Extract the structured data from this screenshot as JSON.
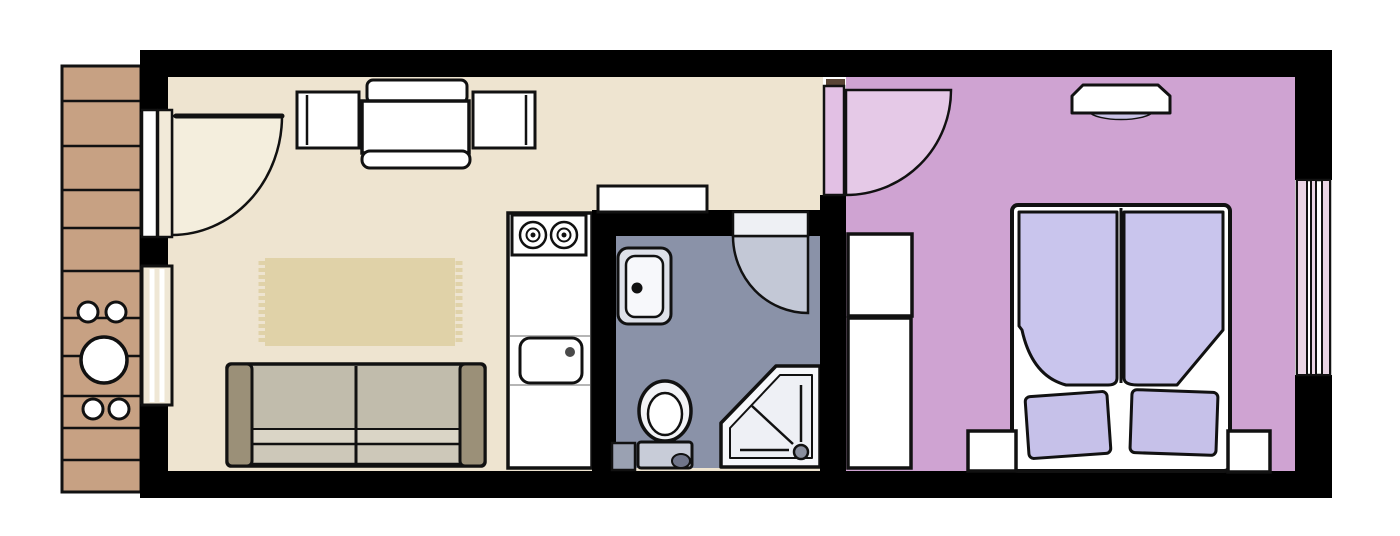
{
  "meta": {
    "title": "apartment-floor-plan",
    "canvas": {
      "width": 1400,
      "height": 536,
      "background": "#ffffff"
    }
  },
  "rooms": [
    {
      "id": "balcony",
      "label": "balcony",
      "floor_color": "#c7a183"
    },
    {
      "id": "living-room",
      "label": "living-room-kitchen",
      "floor_color": "#eee4d0"
    },
    {
      "id": "bathroom",
      "label": "bathroom",
      "floor_color": "#8a92a8"
    },
    {
      "id": "bedroom",
      "label": "bedroom",
      "floor_color": "#cfa3d2"
    }
  ],
  "palette": {
    "wall": "#000000",
    "outline": "#111111",
    "living_floor": "#eee4d0",
    "bedroom_floor": "#cfa3d2",
    "bathroom_floor": "#8a92a8",
    "balcony_deck": "#c7a183",
    "rug": "#e0d2a8",
    "sofa_body": "#c1bcac",
    "sofa_armrest": "#9b9078",
    "duvet": "#c9c5ed",
    "pillow": "#c6c1e9",
    "door_swing_cream": "#f4eedd",
    "door_swing_gray": "#c3c8d6",
    "door_swing_pink": "#e5c9e7"
  },
  "shapes": [
    {
      "n": "balcony-deck",
      "t": "rect",
      "x": 62,
      "y": 66,
      "w": 79,
      "h": 426,
      "fill": "#c7a183",
      "stroke": "#111111",
      "sw": 3
    },
    {
      "n": "balcony-plank-line",
      "t": "line",
      "x1": 63,
      "y1": 101,
      "x2": 140,
      "y2": 101,
      "stroke": "#111111",
      "sw": 2.5
    },
    {
      "n": "balcony-plank-line",
      "t": "line",
      "x1": 63,
      "y1": 146,
      "x2": 140,
      "y2": 146,
      "stroke": "#111111",
      "sw": 2.5
    },
    {
      "n": "balcony-plank-line",
      "t": "line",
      "x1": 63,
      "y1": 190,
      "x2": 140,
      "y2": 190,
      "stroke": "#111111",
      "sw": 2.5
    },
    {
      "n": "balcony-plank-line",
      "t": "line",
      "x1": 63,
      "y1": 228,
      "x2": 140,
      "y2": 228,
      "stroke": "#111111",
      "sw": 2.5
    },
    {
      "n": "balcony-plank-line",
      "t": "line",
      "x1": 63,
      "y1": 271,
      "x2": 140,
      "y2": 271,
      "stroke": "#111111",
      "sw": 2.5
    },
    {
      "n": "balcony-plank-line",
      "t": "line",
      "x1": 63,
      "y1": 318,
      "x2": 140,
      "y2": 318,
      "stroke": "#111111",
      "sw": 2.5
    },
    {
      "n": "balcony-plank-line",
      "t": "line",
      "x1": 63,
      "y1": 356,
      "x2": 140,
      "y2": 356,
      "stroke": "#111111",
      "sw": 2.5
    },
    {
      "n": "balcony-plank-line",
      "t": "line",
      "x1": 63,
      "y1": 396,
      "x2": 140,
      "y2": 396,
      "stroke": "#111111",
      "sw": 2.5
    },
    {
      "n": "balcony-plank-line",
      "t": "line",
      "x1": 63,
      "y1": 428,
      "x2": 140,
      "y2": 428,
      "stroke": "#111111",
      "sw": 2.5
    },
    {
      "n": "balcony-plank-line",
      "t": "line",
      "x1": 63,
      "y1": 460,
      "x2": 140,
      "y2": 460,
      "stroke": "#111111",
      "sw": 2.5
    },
    {
      "n": "balcony-stool",
      "t": "circle",
      "cx": 88,
      "cy": 312,
      "r": 10,
      "fill": "#ffffff",
      "stroke": "#111111",
      "sw": 3
    },
    {
      "n": "balcony-stool",
      "t": "circle",
      "cx": 116,
      "cy": 312,
      "r": 10,
      "fill": "#ffffff",
      "stroke": "#111111",
      "sw": 3
    },
    {
      "n": "balcony-stool",
      "t": "circle",
      "cx": 93,
      "cy": 409,
      "r": 10,
      "fill": "#ffffff",
      "stroke": "#111111",
      "sw": 3
    },
    {
      "n": "balcony-stool",
      "t": "circle",
      "cx": 119,
      "cy": 409,
      "r": 10,
      "fill": "#ffffff",
      "stroke": "#111111",
      "sw": 3
    },
    {
      "n": "balcony-table",
      "t": "circle",
      "cx": 104,
      "cy": 360,
      "r": 23,
      "fill": "#ffffff",
      "stroke": "#111111",
      "sw": 3.5
    },
    {
      "n": "wall-top",
      "t": "rect",
      "x": 140,
      "y": 50,
      "w": 1192,
      "h": 27,
      "fill": "#000000"
    },
    {
      "n": "wall-bottom",
      "t": "rect",
      "x": 140,
      "y": 471,
      "w": 1192,
      "h": 27,
      "fill": "#000000"
    },
    {
      "n": "wall-left-upper",
      "t": "rect",
      "x": 140,
      "y": 50,
      "w": 28,
      "h": 62,
      "fill": "#000000"
    },
    {
      "n": "wall-left-mid",
      "t": "rect",
      "x": 140,
      "y": 235,
      "w": 38,
      "h": 31,
      "fill": "#000000"
    },
    {
      "n": "wall-left-lower",
      "t": "rect",
      "x": 140,
      "y": 404,
      "w": 29,
      "h": 70,
      "fill": "#000000"
    },
    {
      "n": "wall-right-upper",
      "t": "rect",
      "x": 1295,
      "y": 50,
      "w": 37,
      "h": 130,
      "fill": "#000000"
    },
    {
      "n": "wall-right-lower",
      "t": "rect",
      "x": 1295,
      "y": 375,
      "w": 37,
      "h": 123,
      "fill": "#000000"
    },
    {
      "n": "living-room-floor",
      "t": "rect",
      "x": 168,
      "y": 77,
      "w": 655,
      "h": 394,
      "fill": "#eee4d0"
    },
    {
      "n": "bedroom-floor",
      "t": "rect",
      "x": 846,
      "y": 77,
      "w": 449,
      "h": 394,
      "fill": "#cfa3d2"
    },
    {
      "n": "entrance-door-swing",
      "t": "path",
      "d": "M 172,116 L 282,116 A 110 119 0 0 1 172,235 Z",
      "fill": "#f4eedd",
      "stroke": "#111111",
      "sw": 2.5
    },
    {
      "n": "entrance-door-leaf",
      "t": "line",
      "x1": 176,
      "y1": 116,
      "x2": 282,
      "y2": 116,
      "stroke": "#111111",
      "sw": 5,
      "cap": "round"
    },
    {
      "n": "entrance-door-jamb",
      "t": "rect",
      "x": 142,
      "y": 110,
      "w": 15,
      "h": 127,
      "fill": "#ffffff",
      "stroke": "#111111",
      "sw": 2.5
    },
    {
      "n": "entrance-door-jamb",
      "t": "rect",
      "x": 158,
      "y": 110,
      "w": 14,
      "h": 127,
      "fill": "#f2ead9",
      "stroke": "#111111",
      "sw": 2.5
    },
    {
      "n": "living-room-window",
      "t": "rect",
      "x": 142,
      "y": 266,
      "w": 30,
      "h": 139,
      "fill": "#efe7d5",
      "stroke": "#111111",
      "sw": 3
    },
    {
      "n": "living-room-window-pane-line",
      "t": "line",
      "x1": 152,
      "y1": 269,
      "x2": 152,
      "y2": 402,
      "stroke": "#ffffff",
      "sw": 5
    },
    {
      "n": "living-room-window-pane-line",
      "t": "line",
      "x1": 162,
      "y1": 269,
      "x2": 162,
      "y2": 402,
      "stroke": "#ffffff",
      "sw": 5
    },
    {
      "n": "dining-chair-top",
      "t": "rect",
      "x": 367,
      "y": 80,
      "w": 100,
      "h": 23,
      "rx": 6,
      "fill": "#ffffff",
      "stroke": "#111111",
      "sw": 3
    },
    {
      "n": "dining-chair-top-backrest",
      "t": "path",
      "d": "M 374,104 Q 417,122 460,104",
      "fill": "none",
      "stroke": "#111111",
      "sw": 3
    },
    {
      "n": "dining-table",
      "t": "rect",
      "x": 362,
      "y": 101,
      "w": 107,
      "h": 52,
      "fill": "#ffffff",
      "stroke": "#111111",
      "sw": 3.5
    },
    {
      "n": "dining-bench-bottom",
      "t": "rect",
      "x": 362,
      "y": 151,
      "w": 108,
      "h": 17,
      "rx": 8,
      "fill": "#ffffff",
      "stroke": "#111111",
      "sw": 3
    },
    {
      "n": "dining-chair-left",
      "t": "rect",
      "x": 297,
      "y": 92,
      "w": 62,
      "h": 56,
      "fill": "#ffffff",
      "stroke": "#111111",
      "sw": 3
    },
    {
      "n": "dining-chair-left-backrest",
      "t": "line",
      "x1": 307,
      "y1": 95,
      "x2": 307,
      "y2": 145,
      "stroke": "#111111",
      "sw": 2.5
    },
    {
      "n": "dining-chair-right",
      "t": "rect",
      "x": 473,
      "y": 92,
      "w": 62,
      "h": 56,
      "fill": "#ffffff",
      "stroke": "#111111",
      "sw": 3
    },
    {
      "n": "dining-chair-right-backrest",
      "t": "line",
      "x1": 526,
      "y1": 95,
      "x2": 526,
      "y2": 145,
      "stroke": "#111111",
      "sw": 2.5
    },
    {
      "n": "rug",
      "t": "rect",
      "x": 265,
      "y": 258,
      "w": 190,
      "h": 88,
      "fill": "#e0d2a8"
    },
    {
      "n": "rug-fringe",
      "t": "line",
      "x1": 262,
      "y1": 261,
      "x2": 262,
      "y2": 344,
      "stroke": "#e0d2a8",
      "sw": 7,
      "dash": "4 3"
    },
    {
      "n": "rug-fringe",
      "t": "line",
      "x1": 459,
      "y1": 261,
      "x2": 459,
      "y2": 344,
      "stroke": "#e0d2a8",
      "sw": 7,
      "dash": "4 3"
    },
    {
      "n": "sofa-body",
      "t": "rect",
      "x": 227,
      "y": 364,
      "w": 258,
      "h": 102,
      "rx": 4,
      "fill": "#c1bcac",
      "stroke": "#111111",
      "sw": 3.5
    },
    {
      "n": "sofa-seat-front",
      "t": "rect",
      "x": 250,
      "y": 429,
      "w": 212,
      "h": 15,
      "fill": "#dad5c6",
      "stroke": "#111111",
      "sw": 2
    },
    {
      "n": "sofa-seat-edge",
      "t": "rect",
      "x": 250,
      "y": 444,
      "w": 212,
      "h": 20,
      "fill": "#cdc8b9",
      "stroke": "#111111",
      "sw": 2.5
    },
    {
      "n": "sofa-cushion-divider",
      "t": "line",
      "x1": 356,
      "y1": 366,
      "x2": 356,
      "y2": 463,
      "stroke": "#111111",
      "sw": 3
    },
    {
      "n": "sofa-armrest-left",
      "t": "rect",
      "x": 227,
      "y": 364,
      "w": 25,
      "h": 102,
      "rx": 5,
      "fill": "#9b9078",
      "stroke": "#111111",
      "sw": 3
    },
    {
      "n": "sofa-armrest-right",
      "t": "rect",
      "x": 460,
      "y": 364,
      "w": 25,
      "h": 102,
      "rx": 5,
      "fill": "#9b9078",
      "stroke": "#111111",
      "sw": 3
    },
    {
      "n": "kitchen-counter",
      "t": "rect",
      "x": 508,
      "y": 213,
      "w": 84,
      "h": 255,
      "fill": "#ffffff",
      "stroke": "#111111",
      "sw": 3.5
    },
    {
      "n": "kitchen-counter-divider",
      "t": "line",
      "x1": 510,
      "y1": 336,
      "x2": 590,
      "y2": 336,
      "stroke": "#b5b5b5",
      "sw": 2
    },
    {
      "n": "kitchen-counter-divider",
      "t": "line",
      "x1": 510,
      "y1": 385,
      "x2": 590,
      "y2": 385,
      "stroke": "#b5b5b5",
      "sw": 2
    },
    {
      "n": "stove",
      "t": "rect",
      "x": 512,
      "y": 215,
      "w": 74,
      "h": 40,
      "fill": "#ffffff",
      "stroke": "#111111",
      "sw": 3
    },
    {
      "n": "stove-burner",
      "t": "circle",
      "cx": 533,
      "cy": 235,
      "r": 13,
      "fill": "none",
      "stroke": "#111111",
      "sw": 2.5
    },
    {
      "n": "stove-burner-ring",
      "t": "circle",
      "cx": 533,
      "cy": 235,
      "r": 6.5,
      "fill": "none",
      "stroke": "#111111",
      "sw": 2
    },
    {
      "n": "stove-burner-dot",
      "t": "circle",
      "cx": 533,
      "cy": 235,
      "r": 2.5,
      "fill": "#111111"
    },
    {
      "n": "stove-burner",
      "t": "circle",
      "cx": 564,
      "cy": 235,
      "r": 13,
      "fill": "none",
      "stroke": "#111111",
      "sw": 2.5
    },
    {
      "n": "stove-burner-ring",
      "t": "circle",
      "cx": 564,
      "cy": 235,
      "r": 6.5,
      "fill": "none",
      "stroke": "#111111",
      "sw": 2
    },
    {
      "n": "stove-burner-dot",
      "t": "circle",
      "cx": 564,
      "cy": 235,
      "r": 2.5,
      "fill": "#111111"
    },
    {
      "n": "kitchen-sink",
      "t": "rect",
      "x": 520,
      "y": 338,
      "w": 62,
      "h": 45,
      "rx": 10,
      "fill": "#ffffff",
      "stroke": "#111111",
      "sw": 3
    },
    {
      "n": "kitchen-sink-drain",
      "t": "circle",
      "cx": 570,
      "cy": 352,
      "r": 5,
      "fill": "#4a4a4a"
    },
    {
      "n": "bathroom-wall-left",
      "t": "rect",
      "x": 592,
      "y": 210,
      "w": 24,
      "h": 261,
      "fill": "#000000"
    },
    {
      "n": "bathroom-wall-top",
      "t": "rect",
      "x": 592,
      "y": 210,
      "w": 253,
      "h": 26,
      "fill": "#000000"
    },
    {
      "n": "hall-shelf",
      "t": "rect",
      "x": 598,
      "y": 186,
      "w": 109,
      "h": 26,
      "fill": "#ffffff",
      "stroke": "#111111",
      "sw": 3
    },
    {
      "n": "bathroom-floor",
      "t": "rect",
      "x": 616,
      "y": 236,
      "w": 204,
      "h": 232,
      "fill": "#8a92a8"
    },
    {
      "n": "bathroom-door-swing",
      "t": "path",
      "d": "M 808,236 L 733,236 A 75 77 0 0 0 808,313 Z",
      "fill": "#c3c8d6",
      "stroke": "#111111",
      "sw": 2.5
    },
    {
      "n": "bathroom-door-leaf",
      "t": "rect",
      "x": 733,
      "y": 212,
      "w": 75,
      "h": 24,
      "fill": "#eef0f4",
      "stroke": "#111111",
      "sw": 2.5
    },
    {
      "n": "bathroom-sink-counter",
      "t": "rect",
      "x": 618,
      "y": 248,
      "w": 53,
      "h": 76,
      "rx": 10,
      "fill": "#dee1e9",
      "stroke": "#111111",
      "sw": 3
    },
    {
      "n": "bathroom-sink-basin",
      "t": "rect",
      "x": 626,
      "y": 256,
      "w": 37,
      "h": 61,
      "rx": 9,
      "fill": "#f7f8fb",
      "stroke": "#111111",
      "sw": 2.5
    },
    {
      "n": "bathroom-sink-drain",
      "t": "circle",
      "cx": 637,
      "cy": 288,
      "r": 5.5,
      "fill": "#111111"
    },
    {
      "n": "bathroom-duct",
      "t": "rect",
      "x": 612,
      "y": 443,
      "w": 23,
      "h": 27,
      "fill": "#9aa1b2",
      "stroke": "#111111",
      "sw": 2.5
    },
    {
      "n": "toilet-tank",
      "t": "rect",
      "x": 638,
      "y": 442,
      "w": 54,
      "h": 26,
      "rx": 3,
      "fill": "#c8ccd8",
      "stroke": "#111111",
      "sw": 3
    },
    {
      "n": "toilet-bowl",
      "t": "ellipse",
      "cx": 665,
      "cy": 411,
      "rx": 26,
      "ry": 30,
      "fill": "#f2f3f6",
      "stroke": "#111111",
      "sw": 3.5
    },
    {
      "n": "toilet-bowl-inner",
      "t": "ellipse",
      "cx": 665,
      "cy": 414,
      "rx": 17,
      "ry": 21,
      "fill": "#ffffff",
      "stroke": "#111111",
      "sw": 2.5
    },
    {
      "n": "toilet-flush-button",
      "t": "ellipse",
      "cx": 681,
      "cy": 461,
      "rx": 9,
      "ry": 7,
      "fill": "#70758a",
      "stroke": "#111111",
      "sw": 2
    },
    {
      "n": "shower",
      "t": "polygon",
      "points": "776,366 820,366 820,467 721,467 721,423",
      "fill": "#f6f7fa",
      "stroke": "#111111",
      "sw": 3.5,
      "join": "round"
    },
    {
      "n": "shower-tray",
      "t": "polygon",
      "points": "780,375 812,375 812,458 730,458 730,428",
      "fill": "#eef0f5",
      "stroke": "#111111",
      "sw": 2,
      "join": "round"
    },
    {
      "n": "shower-line",
      "t": "line",
      "x1": 801,
      "y1": 385,
      "x2": 801,
      "y2": 442,
      "stroke": "#111111",
      "sw": 2.5
    },
    {
      "n": "shower-line",
      "t": "line",
      "x1": 740,
      "y1": 450,
      "x2": 789,
      "y2": 450,
      "stroke": "#111111",
      "sw": 2.5
    },
    {
      "n": "shower-line",
      "t": "line",
      "x1": 752,
      "y1": 406,
      "x2": 793,
      "y2": 444,
      "stroke": "#111111",
      "sw": 2.5
    },
    {
      "n": "shower-drain",
      "t": "circle",
      "cx": 801,
      "cy": 452,
      "r": 7,
      "fill": "#8a8f9e",
      "stroke": "#111111",
      "sw": 2.5
    },
    {
      "n": "bedroom-wall-left",
      "t": "rect",
      "x": 820,
      "y": 195,
      "w": 26,
      "h": 276,
      "fill": "#000000"
    },
    {
      "n": "bedroom-door-threshold",
      "t": "rect",
      "x": 826,
      "y": 79,
      "w": 19,
      "h": 6,
      "fill": "#5a4536"
    },
    {
      "n": "bedroom-door-swing",
      "t": "path",
      "d": "M 846,90 L 951,90 A 105 105 0 0 1 846,195 Z",
      "fill": "#e5c9e7",
      "stroke": "#111111",
      "sw": 2.5
    },
    {
      "n": "bedroom-door-leaf",
      "t": "rect",
      "x": 824,
      "y": 86,
      "w": 20,
      "h": 109,
      "fill": "#e2c0e4",
      "stroke": "#111111",
      "sw": 2.5
    },
    {
      "n": "wardrobe-upper",
      "t": "rect",
      "x": 848,
      "y": 234,
      "w": 64,
      "h": 82,
      "fill": "#ffffff",
      "stroke": "#111111",
      "sw": 3.5
    },
    {
      "n": "wardrobe-lower",
      "t": "rect",
      "x": 848,
      "y": 318,
      "w": 63,
      "h": 150,
      "fill": "#ffffff",
      "stroke": "#111111",
      "sw": 3.5
    },
    {
      "n": "wall-lamp-glow",
      "t": "path",
      "d": "M 1089,112 A 33 10 0 0 0 1153,112 Z",
      "fill": "#c9c2e6",
      "stroke": "#111111",
      "sw": 1.5
    },
    {
      "n": "wall-shelf",
      "t": "path",
      "d": "M 1083,85 L 1158,85 L 1170,96 L 1170,113 L 1072,113 L 1072,96 Z",
      "fill": "#ffffff",
      "stroke": "#111111",
      "sw": 3,
      "join": "round"
    },
    {
      "n": "bed-frame",
      "t": "rect",
      "x": 1012,
      "y": 205,
      "w": 218,
      "h": 266,
      "rx": 6,
      "fill": "#ffffff",
      "stroke": "#111111",
      "sw": 4
    },
    {
      "n": "bed-center-divider",
      "t": "line",
      "x1": 1121,
      "y1": 208,
      "x2": 1121,
      "y2": 383,
      "stroke": "#111111",
      "sw": 3
    },
    {
      "n": "duvet-left",
      "t": "path",
      "d": "M 1019,212 L 1117,212 L 1117,378 Q 1117,385 1108,385 L 1066,385 Q 1032,376 1022,330 L 1019,326 Z",
      "fill": "#c9c5ed",
      "stroke": "#111111",
      "sw": 3,
      "join": "round"
    },
    {
      "n": "duvet-right",
      "t": "path",
      "d": "M 1124,212 L 1223,212 L 1223,330 L 1177,385 L 1138,385 Q 1124,385 1124,378 Z",
      "fill": "#c9c5ed",
      "stroke": "#111111",
      "sw": 3,
      "join": "round"
    },
    {
      "n": "pillow-left",
      "t": "rect",
      "x": 1027,
      "y": 394,
      "w": 82,
      "h": 62,
      "rx": 5,
      "fill": "#c6c1e9",
      "stroke": "#111111",
      "sw": 3,
      "transform": "rotate(-4 1068 425)"
    },
    {
      "n": "pillow-right",
      "t": "rect",
      "x": 1131,
      "y": 391,
      "w": 86,
      "h": 63,
      "rx": 5,
      "fill": "#c6c1e9",
      "stroke": "#111111",
      "sw": 3,
      "transform": "rotate(2 1174 422)"
    },
    {
      "n": "nightstand-left",
      "t": "rect",
      "x": 968,
      "y": 431,
      "w": 48,
      "h": 40,
      "fill": "#ffffff",
      "stroke": "#111111",
      "sw": 3.5
    },
    {
      "n": "nightstand-right",
      "t": "rect",
      "x": 1228,
      "y": 431,
      "w": 42,
      "h": 41,
      "fill": "#ffffff",
      "stroke": "#111111",
      "sw": 3.5
    },
    {
      "n": "bedroom-window-frame",
      "t": "rect",
      "x": 1297,
      "y": 180,
      "w": 33,
      "h": 195,
      "fill": "#ffffff",
      "stroke": "#111111",
      "sw": 2.5
    },
    {
      "n": "bedroom-window-strip",
      "t": "rect",
      "x": 1297,
      "y": 180,
      "w": 10,
      "h": 195,
      "fill": "#e9d4e4",
      "stroke": "#111111",
      "sw": 2
    },
    {
      "n": "bedroom-window-strip",
      "t": "rect",
      "x": 1311,
      "y": 180,
      "w": 5,
      "h": 195,
      "fill": "#e9d4e4",
      "stroke": "#111111",
      "sw": 2
    },
    {
      "n": "bedroom-window-strip",
      "t": "rect",
      "x": 1322,
      "y": 180,
      "w": 8,
      "h": 195,
      "fill": "#e9d4e4",
      "stroke": "#111111",
      "sw": 2
    }
  ]
}
